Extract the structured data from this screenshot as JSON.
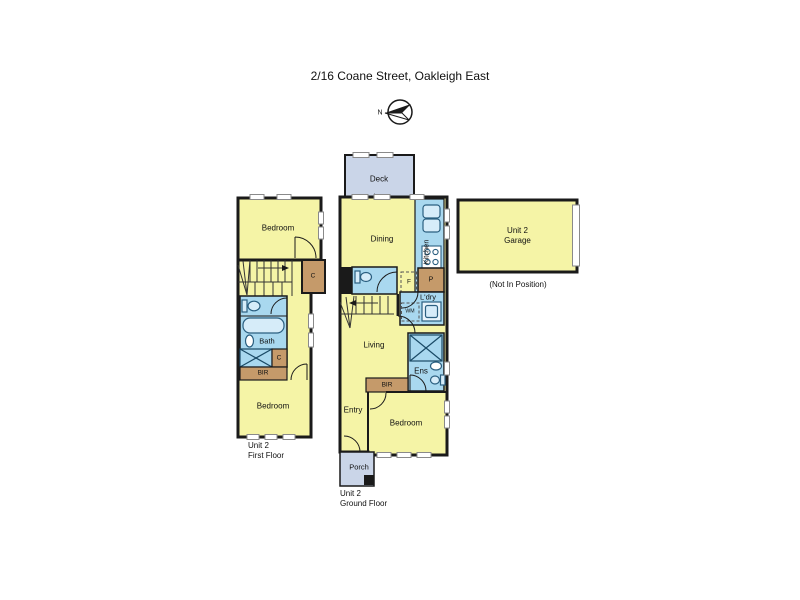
{
  "title": "2/16 Coane Street, Oakleigh East",
  "compass": {
    "north_label": "N"
  },
  "colors": {
    "room_yellow": "#F5F4A6",
    "wet_blue": "#A9D8EF",
    "fixture_blue": "#D6ECF9",
    "deck_blue": "#CAD5E8",
    "robe_brown": "#C59A6A",
    "wall_black": "#1A1A1A",
    "window_white": "#FFFFFF"
  },
  "first_floor": {
    "caption": {
      "line1": "Unit 2",
      "line2": "First Floor"
    },
    "labels": {
      "bedroom_top": "Bedroom",
      "closet": "C",
      "bath": "Bath",
      "shower_closet": "C",
      "bir": "BIR",
      "bedroom_bottom": "Bedroom"
    }
  },
  "ground_floor": {
    "caption": {
      "line1": "Unit 2",
      "line2": "Ground Floor"
    },
    "labels": {
      "deck": "Deck",
      "dining": "Dining",
      "kitchen": "Kitchen",
      "pantry": "P",
      "fridge": "F",
      "laundry": "L'dry",
      "washing_machine": "WM",
      "living": "Living",
      "ensuite": "Ens",
      "bir": "BIR",
      "entry": "Entry",
      "bedroom": "Bedroom",
      "porch": "Porch"
    }
  },
  "garage": {
    "caption": {
      "line1": "Unit 2",
      "line2": "Garage"
    },
    "note": "(Not In Position)"
  }
}
